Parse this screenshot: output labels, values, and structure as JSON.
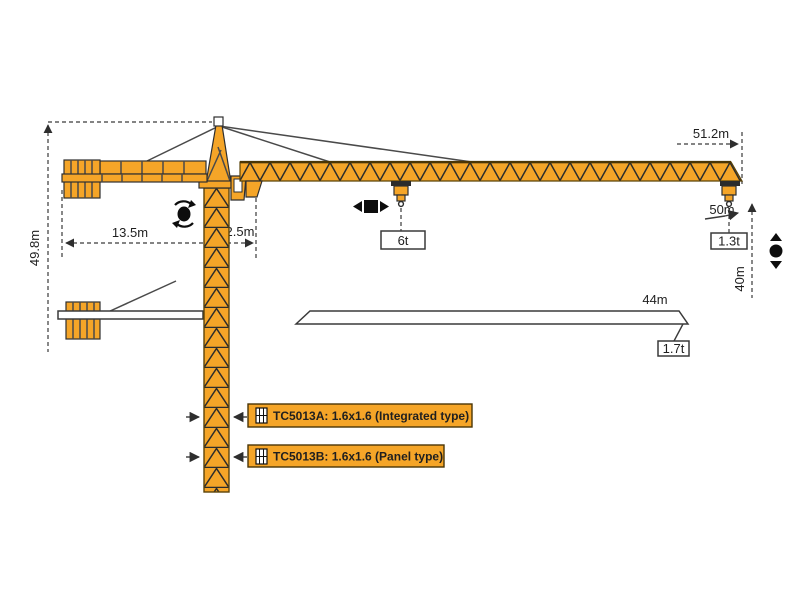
{
  "diagram": {
    "dims": {
      "height": "49.8m",
      "counter_jib": "13.5m",
      "rear_offset": "2.5m",
      "jib_radius": "51.2m",
      "rope_length": "50m",
      "hook_height": "40m",
      "mid_span": "44m"
    },
    "loads": {
      "mid": "6t",
      "tip": "1.3t",
      "mid_span": "1.7t"
    },
    "variants": {
      "a": "TC5013A: 1.6x1.6 (Integrated type)",
      "b": "TC5013B: 1.6x1.6 (Panel type)"
    },
    "colors": {
      "crane": "#F5A528",
      "outline": "#3a3a3a",
      "label_bg": "#F5A528"
    }
  }
}
